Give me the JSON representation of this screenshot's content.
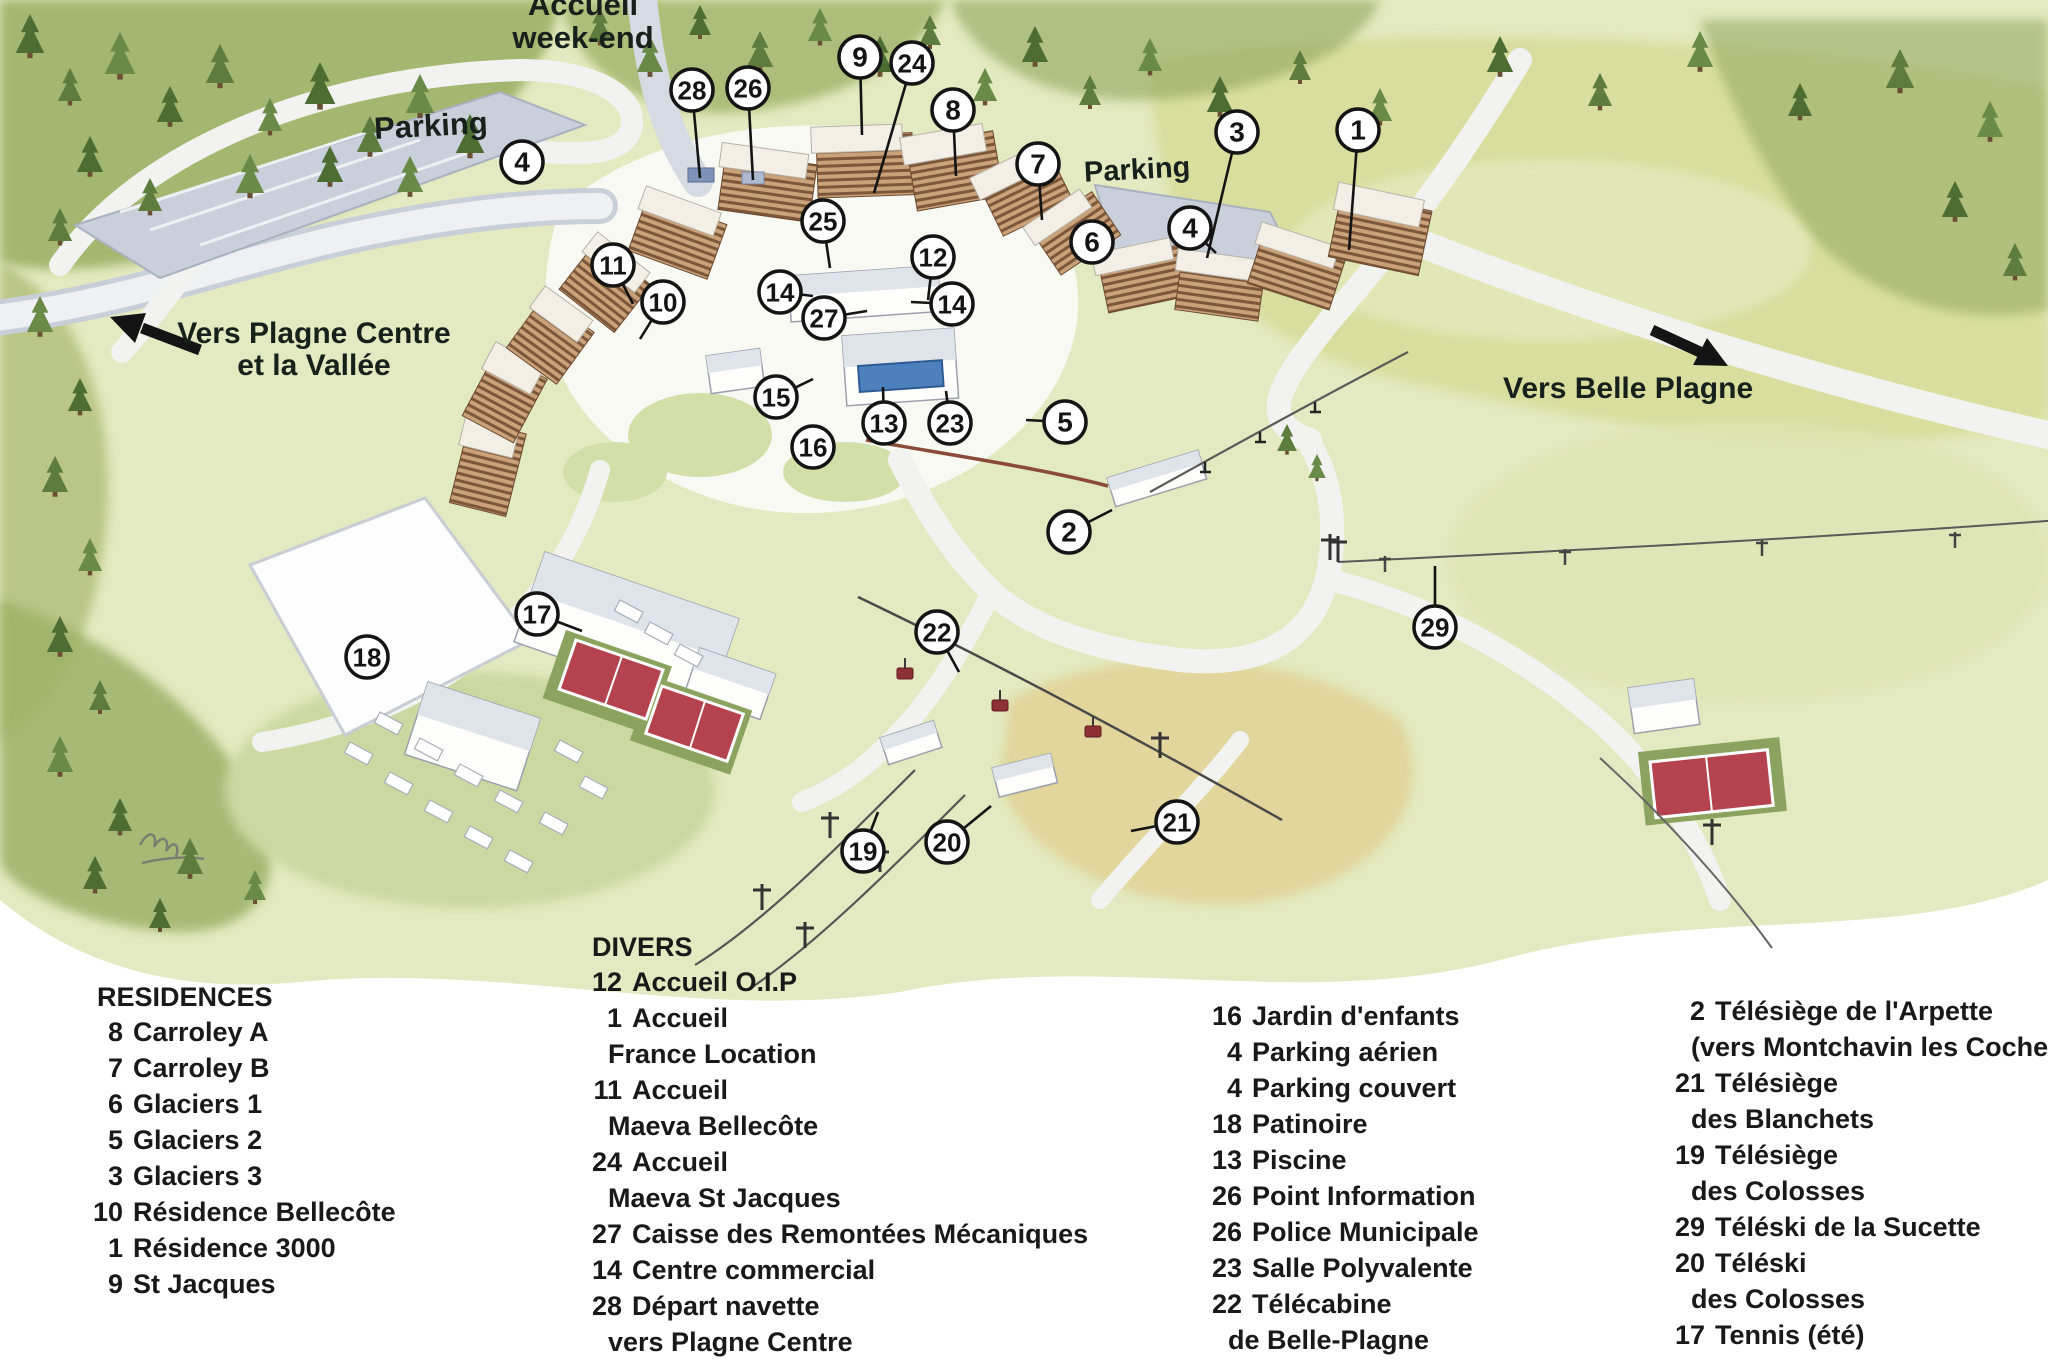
{
  "map": {
    "labels": {
      "accueil_line1": "Accueil",
      "accueil_line2": "week-end",
      "parking_left": "Parking",
      "parking_right": "Parking",
      "vers_plagne_line1": "Vers Plagne Centre",
      "vers_plagne_line2": "et la Vallée",
      "vers_belle_plagne": "Vers Belle Plagne"
    },
    "icons": {
      "left_arrow": "direction-arrow-left",
      "right_arrow": "direction-arrow-right"
    },
    "colors": {
      "marker_ring": "#141414",
      "marker_fill": "#ffffff",
      "forest_green": "#5d7c3e",
      "meadow": "#e3e9c0",
      "sand": "#e2d69c",
      "road": "#f2f3f0",
      "parking_gray": "#c9cfdb",
      "building_tan": "#c9a27a",
      "tennis_red": "#b5434f",
      "pool_blue": "#4d80bd"
    },
    "markers": [
      {
        "n": "28",
        "x": 692,
        "y": 90,
        "tx": 700,
        "ty": 178
      },
      {
        "n": "26",
        "x": 748,
        "y": 88,
        "tx": 753,
        "ty": 180
      },
      {
        "n": "9",
        "x": 860,
        "y": 57,
        "tx": 862,
        "ty": 135
      },
      {
        "n": "24",
        "x": 912,
        "y": 63,
        "tx": 874,
        "ty": 193
      },
      {
        "n": "8",
        "x": 953,
        "y": 110,
        "tx": 956,
        "ty": 176
      },
      {
        "n": "7",
        "x": 1038,
        "y": 164,
        "tx": 1042,
        "ty": 220
      },
      {
        "n": "3",
        "x": 1237,
        "y": 132,
        "tx": 1207,
        "ty": 258
      },
      {
        "n": "1",
        "x": 1358,
        "y": 130,
        "tx": 1349,
        "ty": 250
      },
      {
        "n": "4",
        "x": 522,
        "y": 162
      },
      {
        "n": "4",
        "x": 1190,
        "y": 228,
        "tx": 1216,
        "ty": 253
      },
      {
        "n": "6",
        "x": 1092,
        "y": 242
      },
      {
        "n": "25",
        "x": 823,
        "y": 221,
        "tx": 830,
        "ty": 268
      },
      {
        "n": "11",
        "x": 613,
        "y": 265,
        "tx": 633,
        "ty": 304
      },
      {
        "n": "10",
        "x": 663,
        "y": 302,
        "tx": 640,
        "ty": 339
      },
      {
        "n": "12",
        "x": 933,
        "y": 257,
        "tx": 928,
        "ty": 300
      },
      {
        "n": "14",
        "x": 780,
        "y": 292,
        "tx": 813,
        "ty": 296
      },
      {
        "n": "14",
        "x": 952,
        "y": 304,
        "tx": 911,
        "ty": 302
      },
      {
        "n": "27",
        "x": 824,
        "y": 318,
        "tx": 867,
        "ty": 311
      },
      {
        "n": "15",
        "x": 776,
        "y": 397,
        "tx": 813,
        "ty": 379
      },
      {
        "n": "13",
        "x": 884,
        "y": 423,
        "tx": 883,
        "ty": 387
      },
      {
        "n": "23",
        "x": 950,
        "y": 423,
        "tx": 946,
        "ty": 391
      },
      {
        "n": "16",
        "x": 813,
        "y": 447
      },
      {
        "n": "5",
        "x": 1065,
        "y": 422,
        "tx": 1026,
        "ty": 420
      },
      {
        "n": "2",
        "x": 1069,
        "y": 532,
        "tx": 1112,
        "ty": 510
      },
      {
        "n": "17",
        "x": 537,
        "y": 614,
        "tx": 582,
        "ty": 631
      },
      {
        "n": "18",
        "x": 367,
        "y": 657
      },
      {
        "n": "22",
        "x": 937,
        "y": 632,
        "tx": 959,
        "ty": 672
      },
      {
        "n": "29",
        "x": 1435,
        "y": 627,
        "tx": 1435,
        "ty": 566
      },
      {
        "n": "19",
        "x": 863,
        "y": 851,
        "tx": 878,
        "ty": 812
      },
      {
        "n": "20",
        "x": 947,
        "y": 842,
        "tx": 991,
        "ty": 806
      },
      {
        "n": "21",
        "x": 1177,
        "y": 822,
        "tx": 1131,
        "ty": 831
      }
    ]
  },
  "legend": {
    "residences": {
      "title": "RESIDENCES",
      "items": [
        {
          "num": "8",
          "label": "Carroley A"
        },
        {
          "num": "7",
          "label": "Carroley B"
        },
        {
          "num": "6",
          "label": "Glaciers 1"
        },
        {
          "num": "5",
          "label": "Glaciers 2"
        },
        {
          "num": "3",
          "label": "Glaciers 3"
        },
        {
          "num": "10",
          "label": "Résidence Bellecôte"
        },
        {
          "num": "1",
          "label": "Résidence 3000"
        },
        {
          "num": "9",
          "label": "St Jacques"
        }
      ]
    },
    "divers": {
      "title": "DIVERS",
      "items": [
        {
          "num": "12",
          "label": "Accueil O.I.P"
        },
        {
          "num": "1",
          "label": "Accueil"
        },
        {
          "num": "",
          "label": "France Location"
        },
        {
          "num": "11",
          "label": "Accueil"
        },
        {
          "num": "",
          "label": "Maeva Bellecôte"
        },
        {
          "num": "24",
          "label": "Accueil"
        },
        {
          "num": "",
          "label": "Maeva St Jacques"
        },
        {
          "num": "27",
          "label": "Caisse des Remontées Mécaniques"
        },
        {
          "num": "14",
          "label": "Centre commercial"
        },
        {
          "num": "28",
          "label": "Départ navette"
        },
        {
          "num": "",
          "label": "vers Plagne Centre"
        }
      ]
    },
    "column3": {
      "items": [
        {
          "num": "16",
          "label": "Jardin d'enfants"
        },
        {
          "num": "4",
          "label": "Parking aérien"
        },
        {
          "num": "4",
          "label": "Parking couvert"
        },
        {
          "num": "18",
          "label": "Patinoire"
        },
        {
          "num": "13",
          "label": "Piscine"
        },
        {
          "num": "26",
          "label": "Point Information"
        },
        {
          "num": "26",
          "label": "Police Municipale"
        },
        {
          "num": "23",
          "label": "Salle Polyvalente"
        },
        {
          "num": "22",
          "label": "Télécabine"
        },
        {
          "num": "",
          "label": "de Belle-Plagne"
        }
      ]
    },
    "column4": {
      "items": [
        {
          "num": "2",
          "label": "Télésiège de l'Arpette"
        },
        {
          "num": "",
          "label": "(vers Montchavin les Coches)"
        },
        {
          "num": "21",
          "label": "Télésiège"
        },
        {
          "num": "",
          "label": "des Blanchets"
        },
        {
          "num": "19",
          "label": "Télésiège"
        },
        {
          "num": "",
          "label": "des Colosses"
        },
        {
          "num": "29",
          "label": "Téléski de la Sucette"
        },
        {
          "num": "20",
          "label": "Téléski"
        },
        {
          "num": "",
          "label": "des Colosses"
        },
        {
          "num": "17",
          "label": "Tennis (été)"
        }
      ]
    }
  }
}
